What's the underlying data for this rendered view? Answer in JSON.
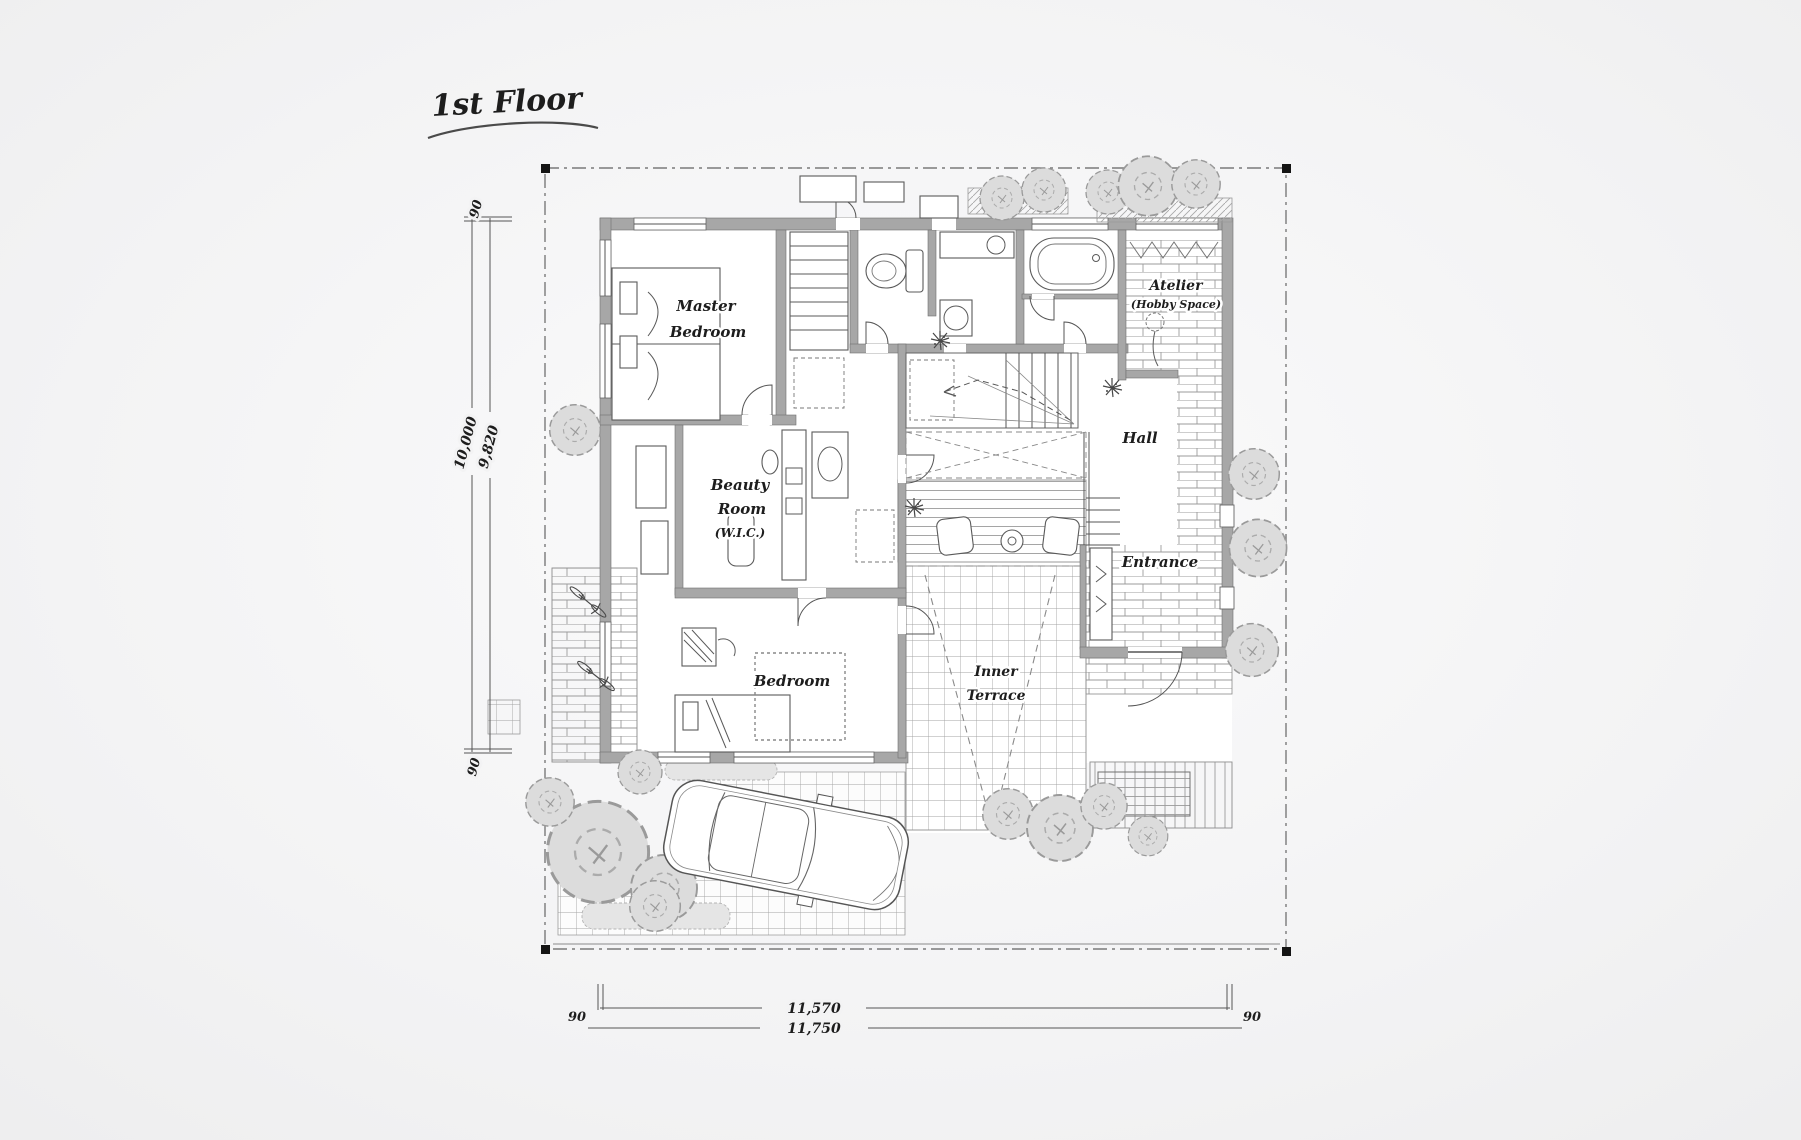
{
  "title": {
    "text": "1st Floor"
  },
  "rooms": {
    "master_bedroom": {
      "line1": "Master",
      "line2": "Bedroom"
    },
    "beauty_room": {
      "line1": "Beauty",
      "line2": "Room",
      "line3": "(W.I.C.)"
    },
    "bedroom": {
      "label": "Bedroom"
    },
    "hall": {
      "label": "Hall"
    },
    "atelier": {
      "line1": "Atelier",
      "line2": "(Hobby Space)"
    },
    "entrance": {
      "label": "Entrance"
    },
    "inner_terrace": {
      "line1": "Inner",
      "line2": "Terrace"
    }
  },
  "dimensions": {
    "left": {
      "offset_top": "90",
      "total": "10,000",
      "inner": "9,820",
      "offset_bottom": "90"
    },
    "bottom": {
      "offset_left": "90",
      "inner": "11,570",
      "total": "11,750",
      "offset_right": "90"
    }
  },
  "colors": {
    "ink": "#3f3f3f",
    "wall": "#a7a7a7",
    "foliage": "#dcdcdc",
    "background": "#f1f1f2"
  }
}
